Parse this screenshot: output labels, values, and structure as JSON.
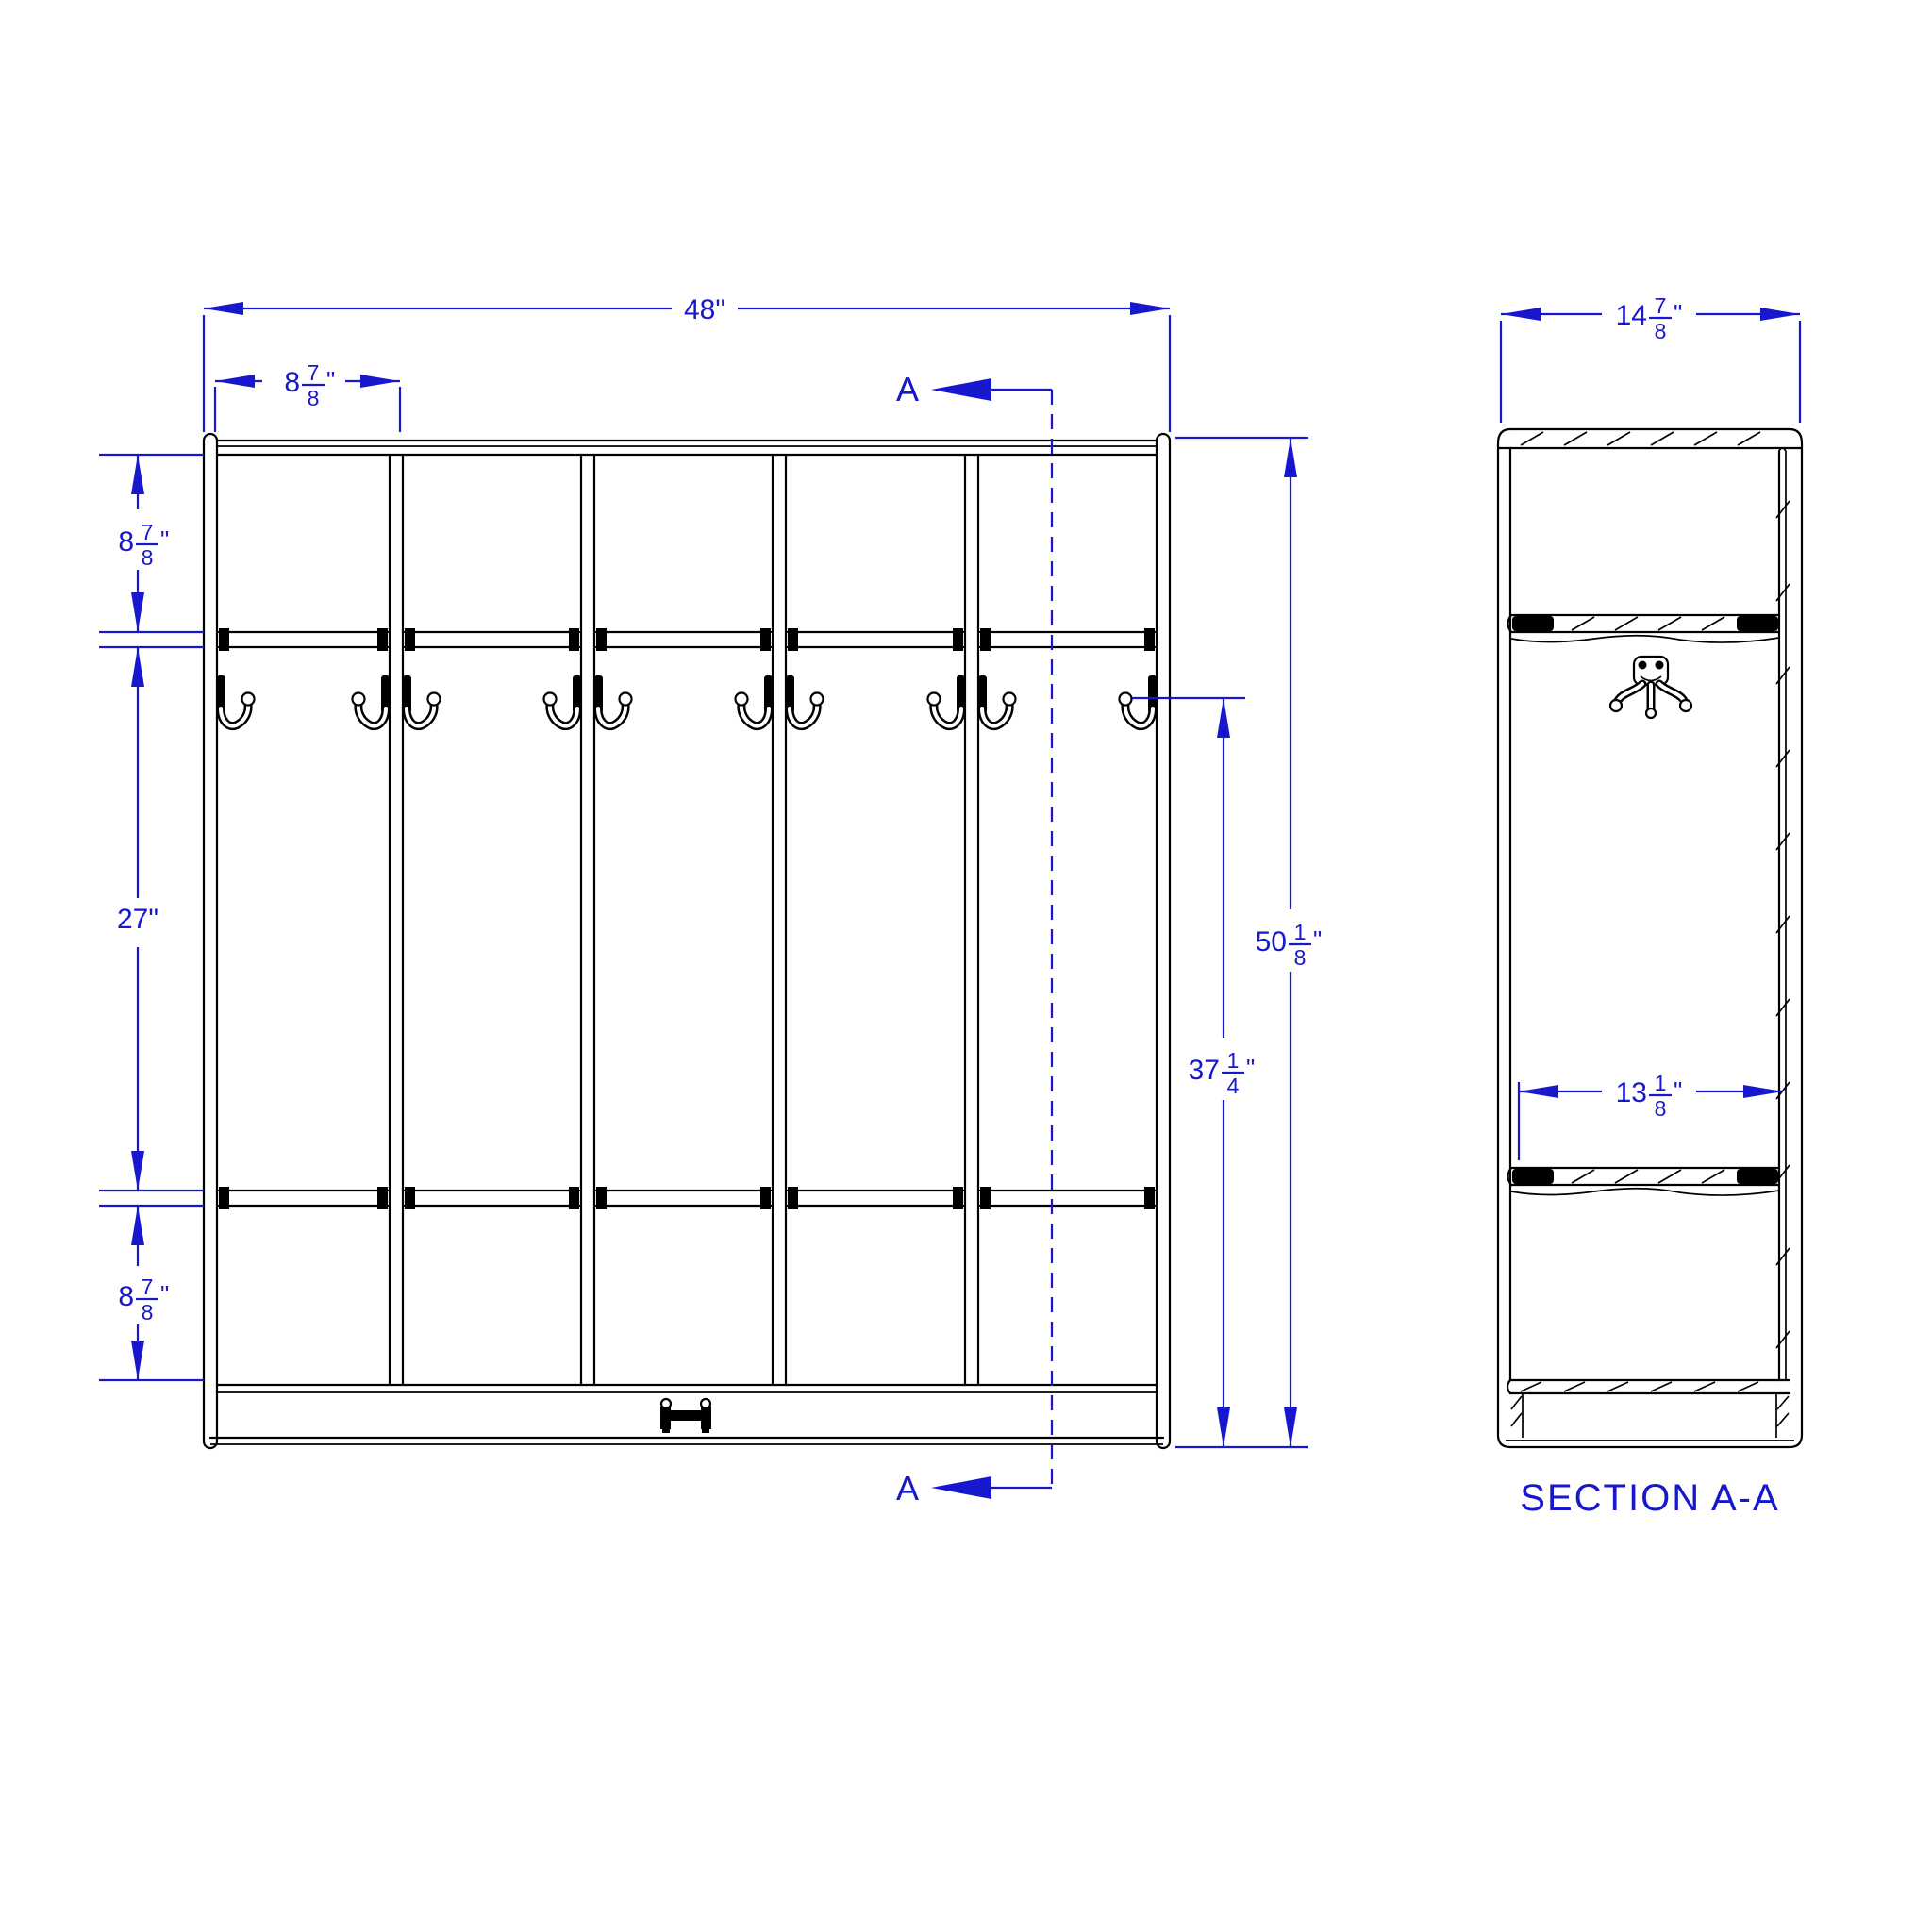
{
  "drawing": {
    "type": "technical-dimension-drawing",
    "subject": "five-section coat locker with double hooks, shelf and base",
    "colors": {
      "dimension": "#1717CD",
      "geometry": "#000000",
      "background": "#FFFFFF"
    },
    "section_marker": "A",
    "front_view": {
      "overall_width": {
        "text": "48\"",
        "whole": "48",
        "quote": "\""
      },
      "section_width": {
        "text": "8 7/8\"",
        "whole": "8",
        "num": "7",
        "den": "8",
        "quote": "\""
      },
      "top_section_height": {
        "text": "8 7/8\"",
        "whole": "8",
        "num": "7",
        "den": "8",
        "quote": "\""
      },
      "middle_section_height": {
        "text": "27\"",
        "whole": "27",
        "quote": "\""
      },
      "bottom_section_height": {
        "text": "8 7/8\"",
        "whole": "8",
        "num": "7",
        "den": "8",
        "quote": "\""
      },
      "hook_height": {
        "text": "37 1/4\"",
        "whole": "37",
        "num": "1",
        "den": "4",
        "quote": "\""
      },
      "overall_height": {
        "text": "50 1/8\"",
        "whole": "50",
        "num": "1",
        "den": "8",
        "quote": "\""
      },
      "sections": 5,
      "hooks": 10
    },
    "section_view": {
      "label": "SECTION A-A",
      "overall_depth": {
        "text": "14 7/8\"",
        "whole": "14",
        "num": "7",
        "den": "8",
        "quote": "\""
      },
      "interior_depth": {
        "text": "13 1/8\"",
        "whole": "13",
        "num": "1",
        "den": "8",
        "quote": "\""
      }
    }
  }
}
